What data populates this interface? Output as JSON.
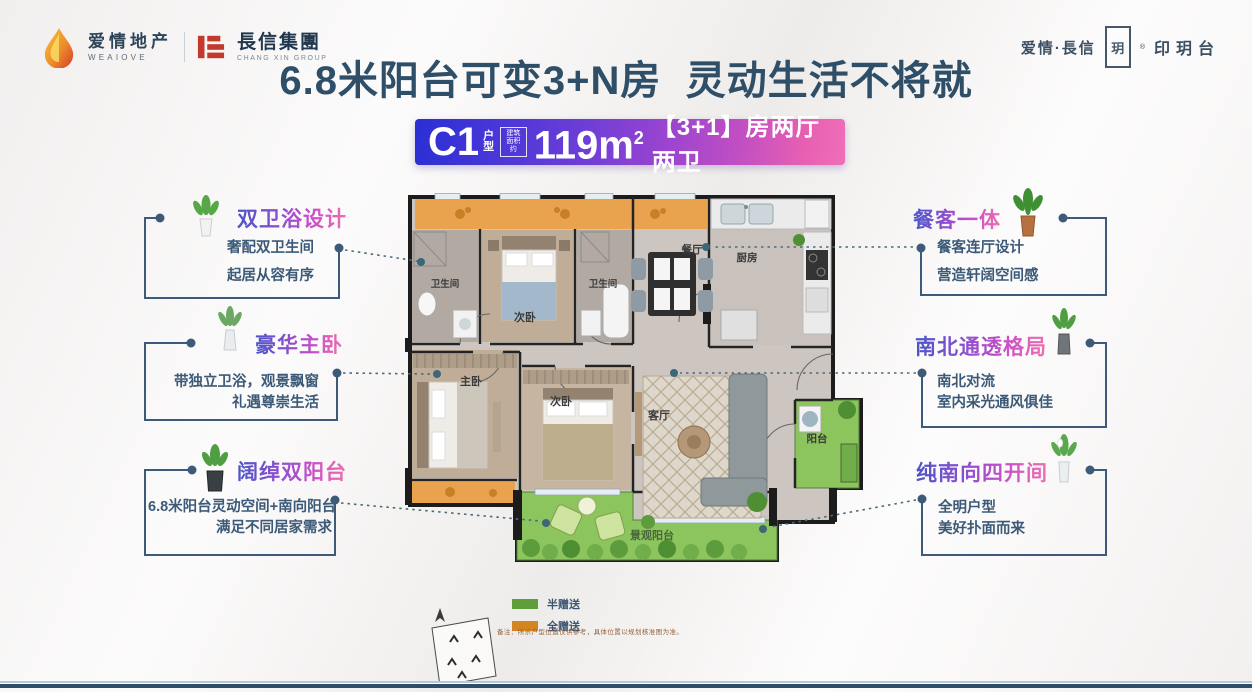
{
  "header": {
    "brand_left": {
      "name_cn": "爱情地产",
      "name_en": "WEAIOVE",
      "partner_cn": "長信集團",
      "partner_en": "CHANG XIN GROUP"
    },
    "brand_right": {
      "prefix": "爱情·長信",
      "seal_char": "玥",
      "reg": "®",
      "project": "印玥台"
    },
    "headline": "6.8米阳台可变3+N房  灵动生活不将就"
  },
  "badge": {
    "unit": "C1",
    "unit_suffix_top": "户",
    "unit_suffix_bottom": "型",
    "area_box_line1": "建筑",
    "area_box_line2": "面积约",
    "area": "119m",
    "area_sup": "2",
    "layout": "【3+1】房两厅两卫"
  },
  "floorplan": {
    "rooms": {
      "bath_left": "卫生间",
      "bedroom_top": "次卧",
      "bath_right": "卫生间",
      "dining": "餐厅",
      "kitchen": "厨房",
      "master_bedroom": "主卧",
      "bedroom_mid": "次卧",
      "living": "客厅",
      "balcony": "阳台",
      "view_balcony": "景观阳台"
    }
  },
  "callouts_left": [
    {
      "title": "双卫浴设计",
      "line1": "奢配双卫生间",
      "line2": "起居从容有序"
    },
    {
      "title": "豪华主卧",
      "line1": "带独立卫浴，观景飘窗",
      "line2": "礼遇尊崇生活"
    },
    {
      "title": "阔绰双阳台",
      "line1": "6.8米阳台灵动空间+南向阳台",
      "line2": "满足不同居家需求"
    }
  ],
  "callouts_right": [
    {
      "title": "餐客一体",
      "line1": "餐客连厅设计",
      "line2": "营造轩阔空间感"
    },
    {
      "title": "南北通透格局",
      "line1": "南北对流",
      "line2": "室内采光通风俱佳"
    },
    {
      "title": "纯南向四开间",
      "line1": "全明户型",
      "line2": "美好扑面而来"
    }
  ],
  "legend": {
    "half_gift": "半赠送",
    "full_gift": "全赠送",
    "half_gift_color": "#5f9e3b",
    "full_gift_color": "#d4851f",
    "note": "备注：所示户型位置仅供参考，具体位置以规划核准图为准。"
  },
  "colors": {
    "headline": "#2f4e67",
    "callout_text": "#3c5a78",
    "badge_gradient_start": "#2a2fd4",
    "badge_gradient_end": "#ef6fb8",
    "balcony_green": "#8cc45e",
    "gift_orange": "#e9a34e"
  }
}
